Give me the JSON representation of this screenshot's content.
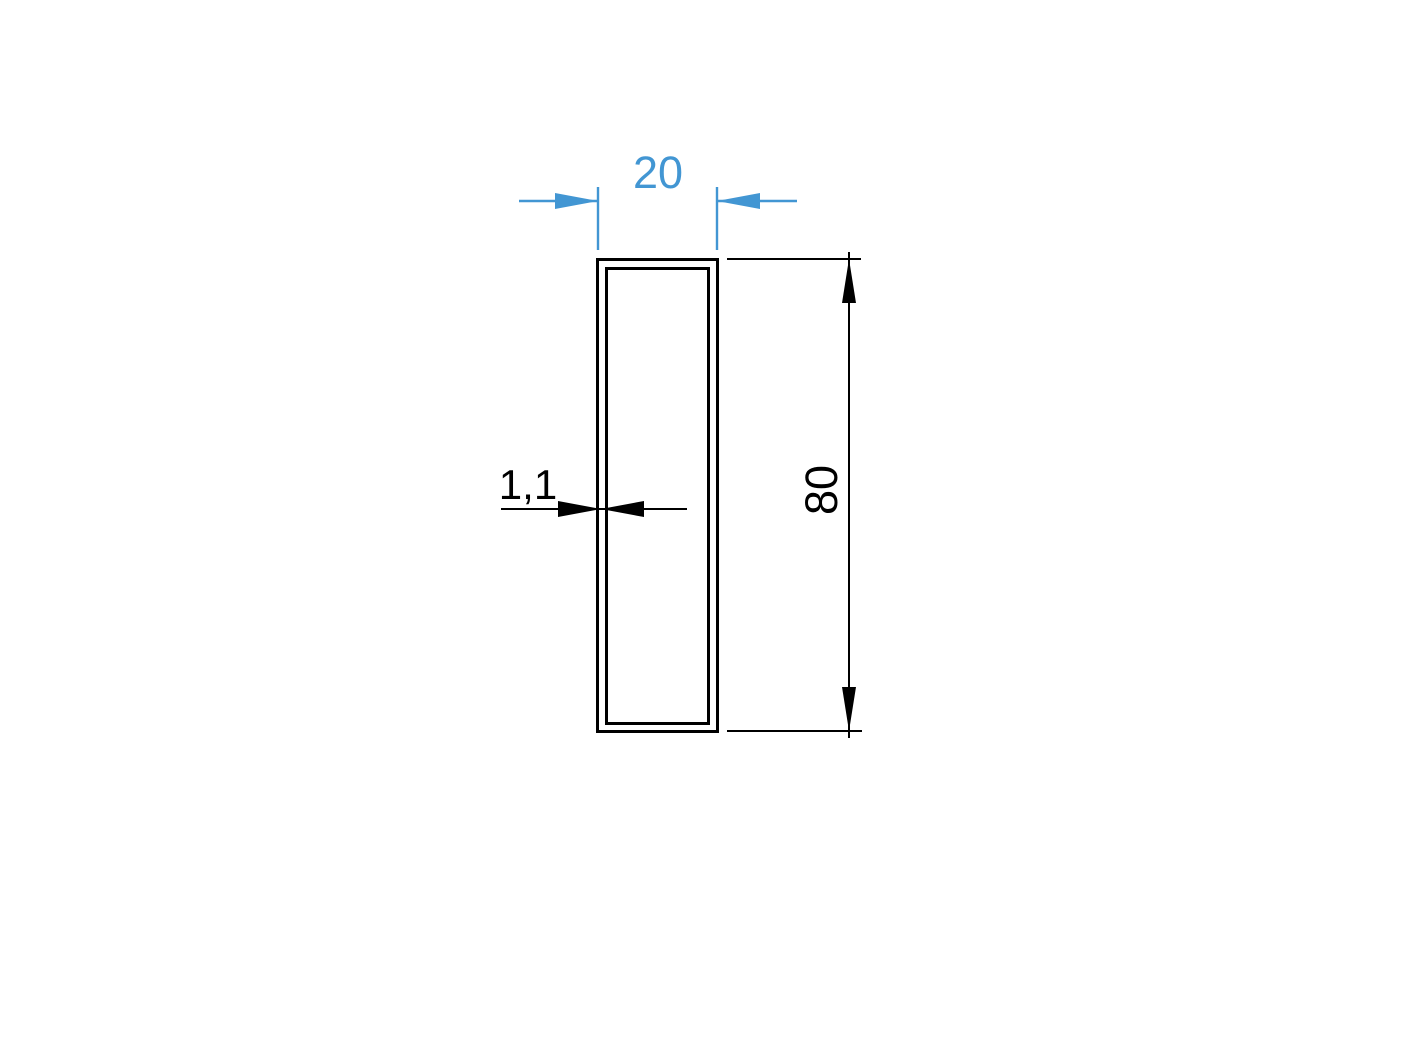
{
  "colors": {
    "accent": "#4296d3",
    "line": "#000000",
    "background": "#ffffff"
  },
  "dimensions": {
    "width": {
      "value": "20"
    },
    "height": {
      "value": "80"
    },
    "wall_thickness": {
      "value": "1,1"
    }
  }
}
